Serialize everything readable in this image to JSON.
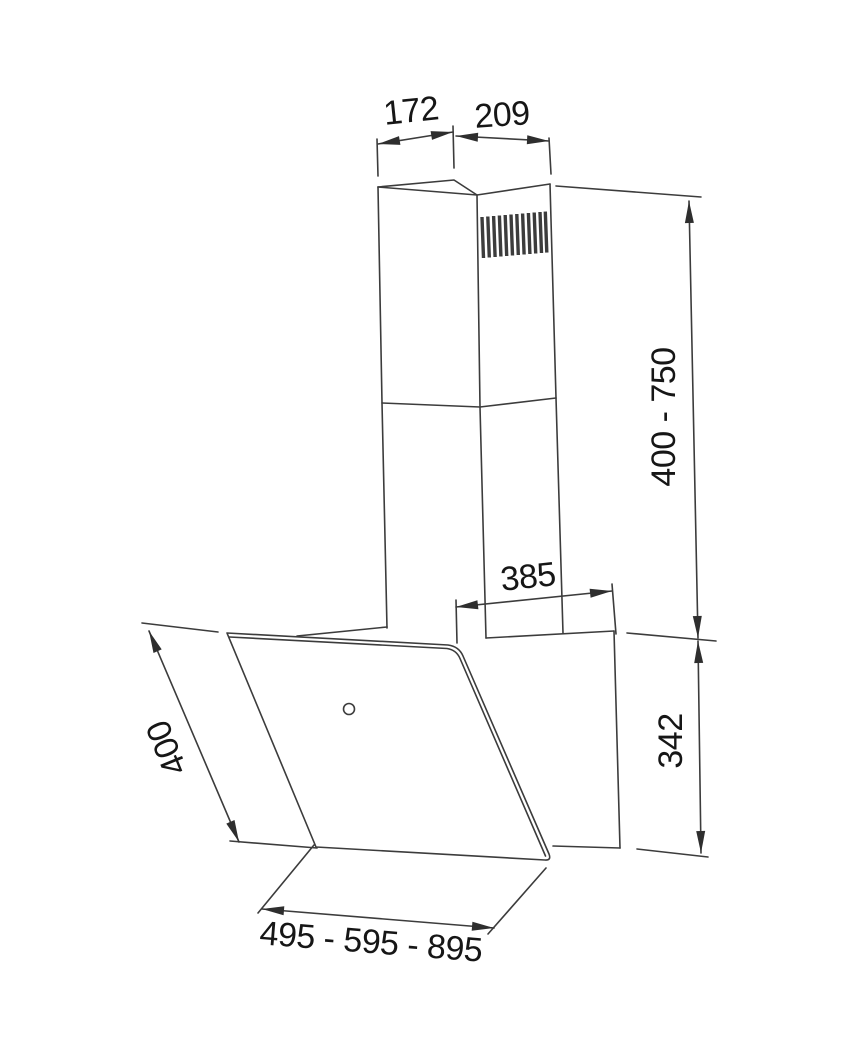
{
  "diagram": {
    "labels": {
      "top_left": "172",
      "top_right": "209",
      "right_upper": "400 - 750",
      "mid_depth": "385",
      "right_lower": "342",
      "left_diagonal": "400",
      "bottom_width": "495 - 595 - 895"
    },
    "colors": {
      "line": "#3c3c3c",
      "text": "#161616",
      "background": "#ffffff"
    }
  }
}
